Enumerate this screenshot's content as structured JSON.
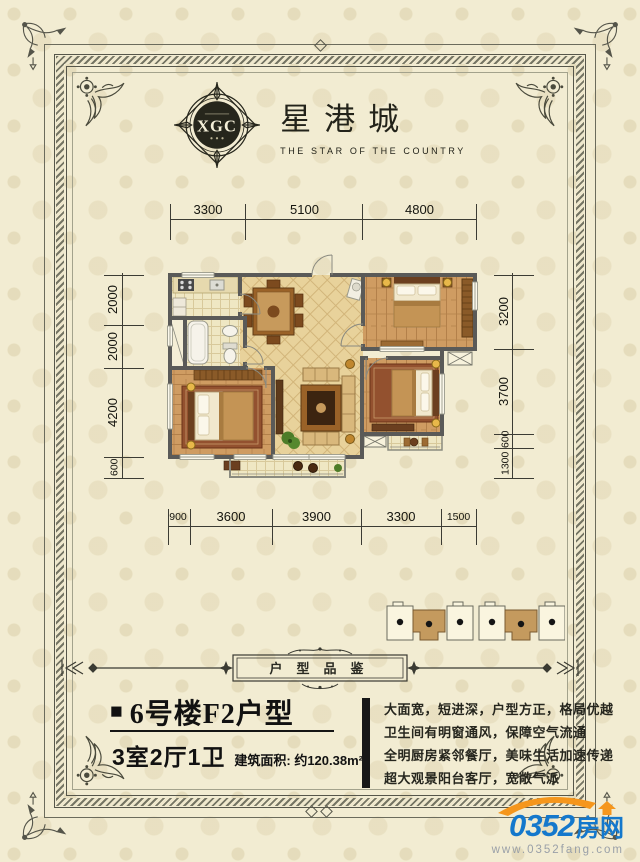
{
  "logo": {
    "monogram": "XGC",
    "name": "星港城",
    "tagline": "THE STAR OF THE COUNTRY"
  },
  "floorplan": {
    "dims_top": [
      "3300",
      "5100",
      "4800"
    ],
    "dims_bottom": [
      "900",
      "3600",
      "3900",
      "3300",
      "1500"
    ],
    "dims_left": [
      "2000",
      "2000",
      "4200",
      "600"
    ],
    "dims_right": [
      "3200",
      "3700",
      "600",
      "1300"
    ]
  },
  "banner": {
    "label": "户型品鉴"
  },
  "unit": {
    "bullet": "■",
    "title": "6号楼F2户型",
    "rooms": "3室2厅1卫",
    "area": "建筑面积: 约120.38m²"
  },
  "description": {
    "lines": [
      "大面宽，短进深，户型方正，格局优越",
      "卫生间有明窗通风，保障空气流通",
      "全明厨房紧邻餐厅，美味生活加速传递",
      "超大观景阳台客厅，宽敞气派"
    ]
  },
  "watermark": {
    "number": "0352",
    "suffix": "房网",
    "url": "www.0352fang.com"
  },
  "colors": {
    "background": "#f2ecd2",
    "frame": "#56564a",
    "wall": "#5a5a58",
    "wood_floor": "#cf9c62",
    "tile_floor": "#efe7c3",
    "diagonal_tile": "#e8d29b",
    "highlight_unit": "#c49a5e",
    "brand_blue": "#1478cc",
    "brand_orange": "#f5961c"
  }
}
